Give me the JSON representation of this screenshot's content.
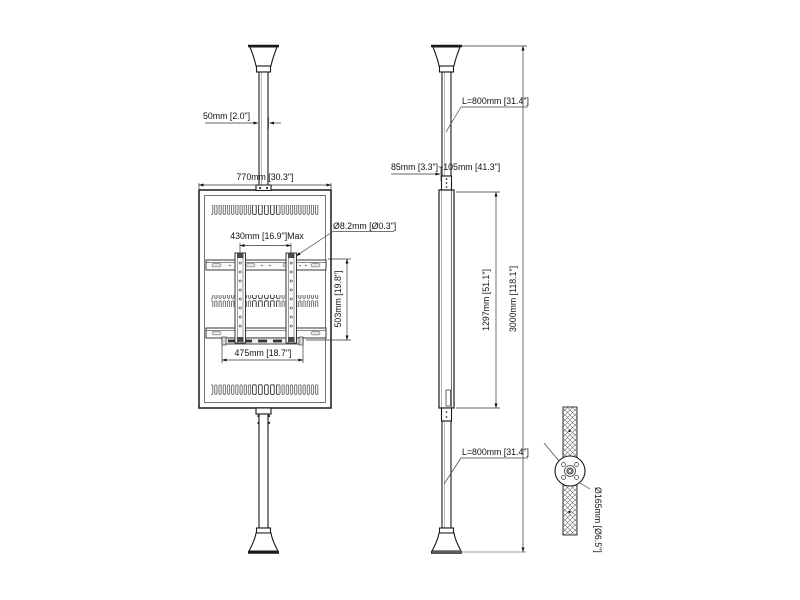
{
  "drawing": {
    "title": "ceiling-to-floor display mount technical drawing",
    "views": {
      "front": "front view with display panel on pole",
      "side": "side view with overall heights",
      "detail": "floor/ceiling flange section detail"
    },
    "labels": {
      "pole_width": "50mm [2.0\"]",
      "display_width": "770mm [30.3\"]",
      "hole_pitch_max": "430mm [16.9\"]Max",
      "hole_diameter": "Ø8.2mm [Ø0.3\"]",
      "bracket_height": "503mm [19.8\"]",
      "rail_width": "475mm [18.7\"]",
      "upper_pole_length": "L=800mm [31.4\"]",
      "adjust_range": "85mm [3.3\"]~105mm [41.3\"]",
      "panel_height": "1297mm [51.1\"]",
      "total_height": "3000mm [118.1\"]",
      "lower_pole_length": "L=800mm [31.4\"]",
      "flange_diameter": "Ø165mm [Ø6.5\"]"
    },
    "colors": {
      "line": "#1a1a1a",
      "dimension_line": "#333333",
      "background": "#ffffff",
      "floor_line": "#9a9a9a",
      "hatch": "#666666"
    }
  }
}
